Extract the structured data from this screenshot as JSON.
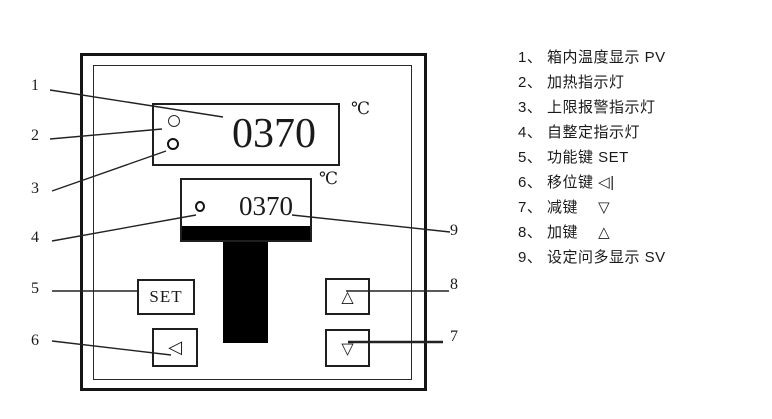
{
  "device": {
    "pv_display": {
      "value": "0370",
      "unit": "℃"
    },
    "sv_display": {
      "value": "0370",
      "unit": "℃"
    },
    "buttons": {
      "set": "SET",
      "shift": "◁",
      "up": "△",
      "down": "▽"
    }
  },
  "callouts": {
    "labels": [
      "1",
      "2",
      "3",
      "4",
      "5",
      "6",
      "7",
      "8",
      "9"
    ]
  },
  "legend": {
    "items": [
      "1、 箱内温度显示 PV",
      "2、 加热指示灯",
      "3、 上限报警指示灯",
      "4、 自整定指示灯",
      "5、 功能键 SET",
      "6、 移位键 ◁|",
      "7、 减键　 ▽",
      "8、 加键　 △",
      "9、 设定问多显示 SV"
    ]
  },
  "colors": {
    "line": "#1f1f1f",
    "fill": "#000000",
    "background": "#ffffff"
  }
}
